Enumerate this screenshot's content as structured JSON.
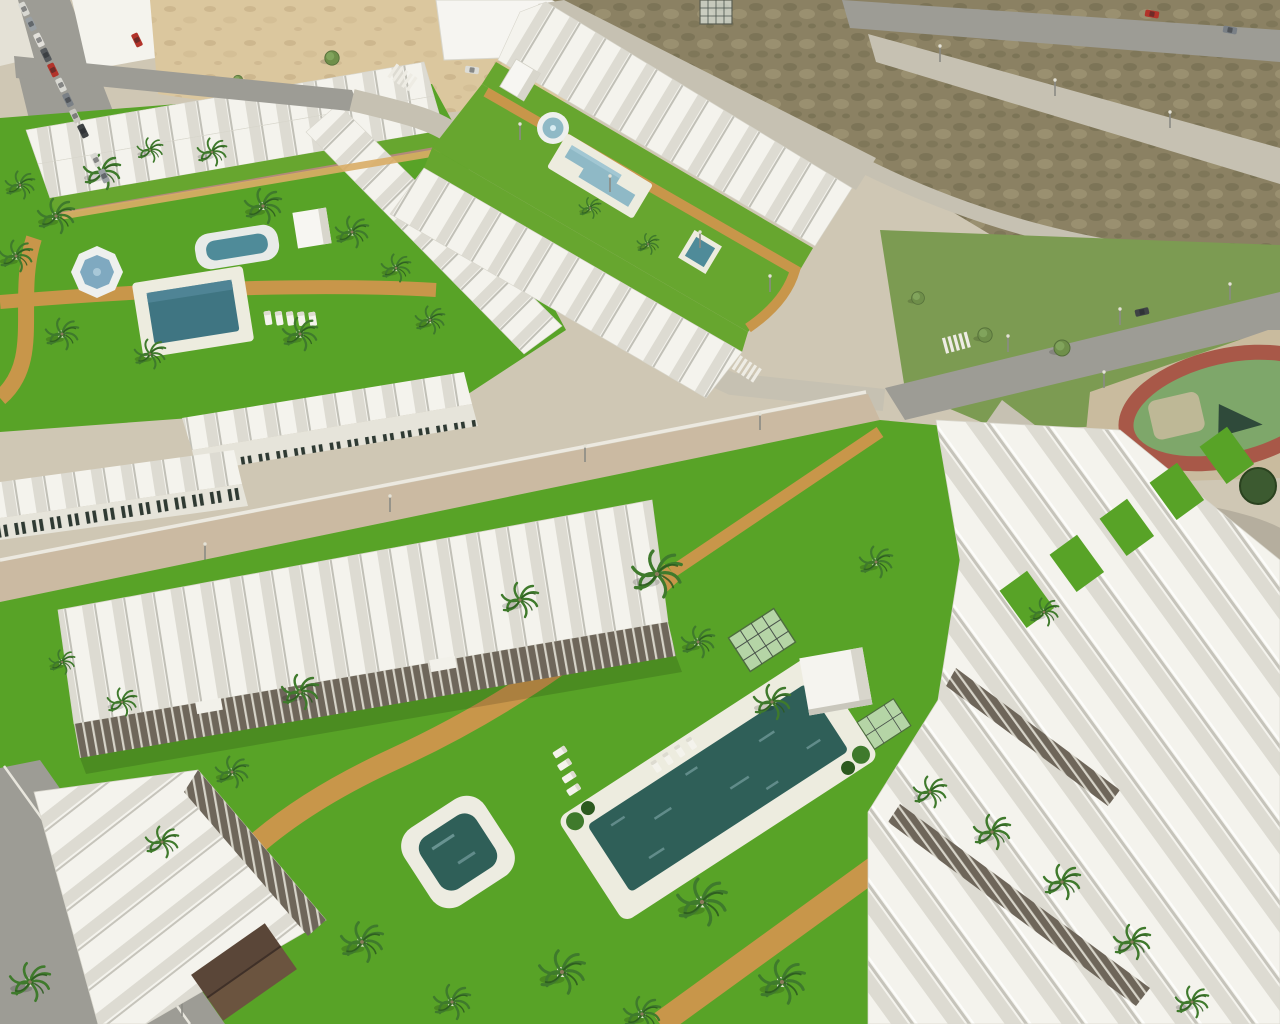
{
  "scene": {
    "title": "Aerial 3D architectural render of a new-build Mediterranean residential complex with communal pools and gardens beside an existing town",
    "setting": "daytime drone-style computer generated visualization, no visible text or UI elements",
    "regions": [
      {
        "name": "old-town",
        "label": "Existing town street grid with parked cars and white buildings"
      },
      {
        "name": "sandy-lot",
        "label": "Vacant sandy lot with scrub"
      },
      {
        "name": "scrub-field",
        "label": "Undeveloped brown scrub field crossed by new light-concrete roads"
      },
      {
        "name": "west-complex",
        "label": "West terraced-house complex with communal lawn, octagonal fountain and two pools"
      },
      {
        "name": "central-complex",
        "label": "Central terraced rows flanking a long lawn strip with round fountain, lap pool and square plunge pool"
      },
      {
        "name": "south-complex",
        "label": "South apartment complex with pergola terraces, large main pool, small pool and palm garden"
      },
      {
        "name": "playground",
        "label": "Public playground with red oval track and green courts"
      },
      {
        "name": "pine-grove",
        "label": "Dense dark pine grove"
      },
      {
        "name": "avenue",
        "label": "Gray asphalt avenue with zebra crosswalks and street lamps"
      }
    ],
    "objects": {
      "swimming_pools": 6,
      "fountains": 2,
      "palm_trees": 34,
      "sun_loungers": 13,
      "street_lamps": 12,
      "cars_moving": 4,
      "cars_parked": 13,
      "storage_cubes": 2,
      "glass_pergolas": 3,
      "wooden_gazebo": 1
    }
  },
  "palette": {
    "concrete": "#cfc7b4",
    "sand": "#dbc79e",
    "sandDot": "#c3ac83",
    "dirt": "#8b8163",
    "dirtDark": "#6e6a4c",
    "dirtLight": "#a99f7e",
    "road": "#9d9c95",
    "roadLight": "#c6c1b2",
    "lawn": "#58a327",
    "lawnDark": "#46851d",
    "lawn2": "#67a62f",
    "grassNat": "#7c9b52",
    "path": "#c8964a",
    "pathLight": "#d9ad66",
    "pool": "#2f5f58",
    "poolLight": "#8fb9c6",
    "poolMid": "#4f8b99",
    "deck": "#edecdf",
    "roofWhite": "#f4f3ed",
    "roofShade": "#dddbd2",
    "roofLine": "#97958a",
    "wall": "#e6e4da",
    "wallShade": "#cfcdc2",
    "pergola": "#6e665a",
    "brick": "#b08a7a",
    "palmGreen": "#3f7a2c",
    "palmDark": "#2c5a1f",
    "trunk": "#8a7a5c",
    "pine": "#3c5a30",
    "pineDark": "#2a421f",
    "treeOlive": "#6f8f4a",
    "track": "#a85848",
    "court": "#7ea76a",
    "plaza": "#c9bb9e",
    "carRed": "#b2332a",
    "spark": "#bfe0e8"
  }
}
